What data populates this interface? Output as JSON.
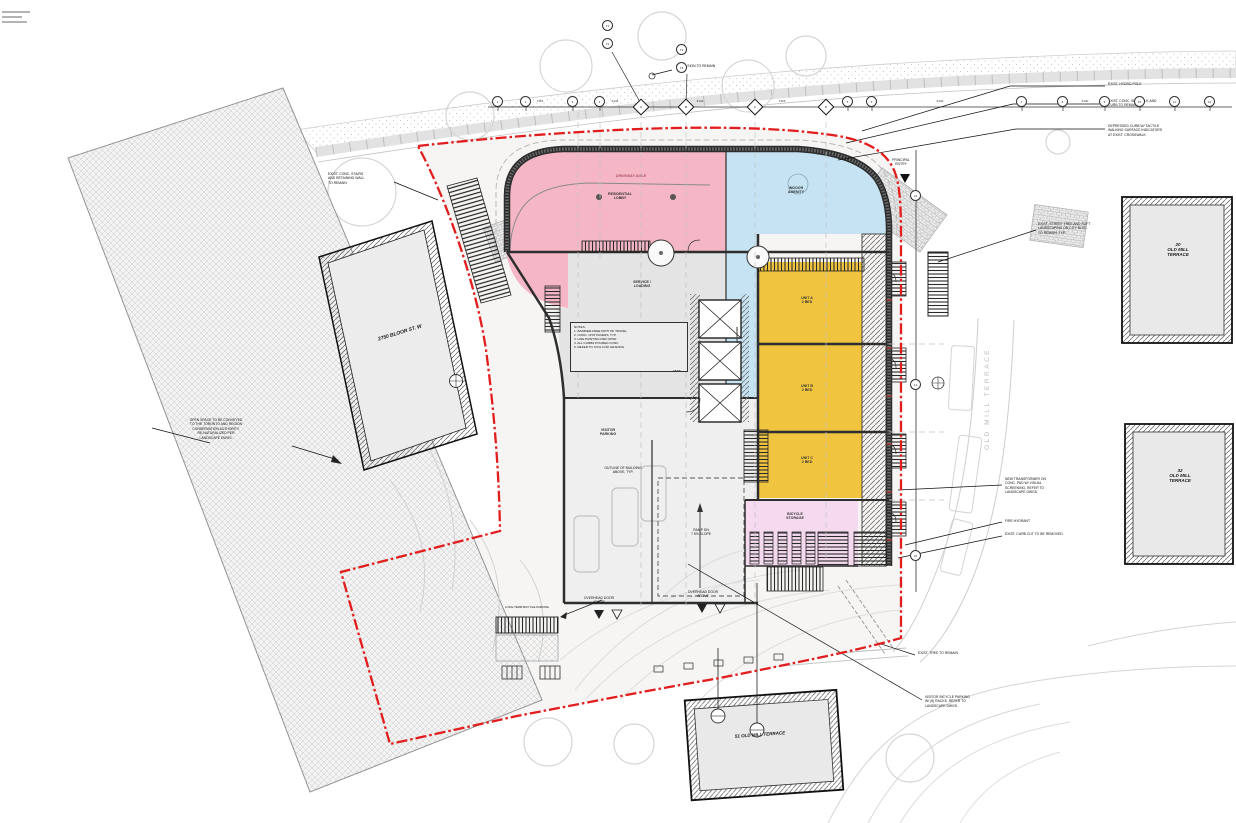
{
  "colors": {
    "zone_pink": "#f5b6c6",
    "zone_blue": "#c5e3f2",
    "zone_yellow": "#f1c440",
    "zone_lilac": "#f4d9ef",
    "zone_gray": "#e4e4e4",
    "property_line_red": "#e11d1d",
    "wall_dark": "#2e2e2e",
    "context_gray": "#cfcfcf"
  },
  "buildings": {
    "b2750": "2750 BLOOR ST. W",
    "b20": "20\nOLD MILL\nTERRACE",
    "b32": "32\nOLD MILL\nTERRACE",
    "b51": "51 OLD MILL TERRACE"
  },
  "street": {
    "name_vertical": "OLD MILL TERRACE"
  },
  "annotations": [
    {
      "text": "EXIST. HYDRO POLE"
    },
    {
      "text": "EXIST. CONC. SIDEWALK AND\nCURB TO REMAIN"
    },
    {
      "text": "DEPRESSED CURB W/ TACTILE\nWALKING SURFACE INDICATORS\nAT EXIST. CROSSWALK"
    },
    {
      "text": "EXIST. STREET TREE AND SOFT\nLANDSCAPING ON CITY BLVD.\nTO REMAIN, TYP."
    },
    {
      "text": "NEW TRANSFORMER ON\nCONC. PAD W/ VISUAL\nSCREENING, REFER TO\nLANDSCAPE DWGS."
    },
    {
      "text": "FIRE HYDRANT"
    },
    {
      "text": "EXIST. CURB CUT TO BE REMOVED"
    },
    {
      "text": "EXIST. TREE TO REMAIN"
    },
    {
      "text": "VISITOR BICYCLE PARKING\nW/ (6) RACKS, REFER TO\nLANDSCAPE DWGS."
    },
    {
      "text": "EXIST. CONC. STAIRS\nAND RETAINING WALL\nTO REMAIN"
    },
    {
      "text": "OPEN SPACE TO BE CONVEYED\nTO THE TORONTO AND REGION\nCONSERVATION AUTHORITY,\nRE-NATURALIZED PER\nLANDSCAPE DWGS."
    },
    {
      "text": "EXIST. SIGN TO REMAIN"
    },
    {
      "text": "PRINCIPAL\nENTRY"
    },
    {
      "text": "LONG-TERM BICYCLE PARKING"
    },
    {
      "text": "NOTES:\n1. BARRIER-FREE PATH OF TRAVEL\n2. CONC. UNIT PAVERS, TYP.\n3. LINE PAINTING PER OPSD\n4. ALL CURBS POURED CONC.\n5. REFER TO CIVIL FOR GRADING"
    },
    {
      "text": "OUTLINE OF BUILDING\nABOVE, TYP."
    },
    {
      "text": "RAMP DN\n7.5% SLOPE"
    },
    {
      "text": "OVERHEAD DOOR\nABOVE"
    },
    {
      "text": "OVERHEAD DOOR\nABOVE"
    }
  ],
  "interior": {
    "lobby": "RESIDENTIAL\nLOBBY",
    "amenity": "INDOOR\nAMENITY",
    "corridor": "CORRIDOR",
    "unit_a": "UNIT A\n2 BED",
    "unit_b": "UNIT B\n2 BED",
    "unit_c": "UNIT C\n2 BED",
    "service": "SERVICE /\nLOADING",
    "visitor": "VISITOR\nPARKING",
    "bike": "BICYCLE\nSTORAGE",
    "vest": "VEST.",
    "driveway": "DRIVEWAY AISLE"
  },
  "grid": {
    "top_bubbles": [
      "1",
      "2",
      "3",
      "4",
      "5",
      "6",
      "7",
      "8",
      "9",
      "10",
      "11",
      "12"
    ],
    "diamonds": [
      "A",
      "B",
      "C",
      "D"
    ],
    "right_bubbles": [
      "13",
      "14",
      "15"
    ],
    "tags": [
      "T1",
      "T2",
      "T3",
      "T4"
    ],
    "dims": [
      "7315",
      "9144",
      "9144",
      "7315",
      "6100",
      "6100"
    ]
  }
}
